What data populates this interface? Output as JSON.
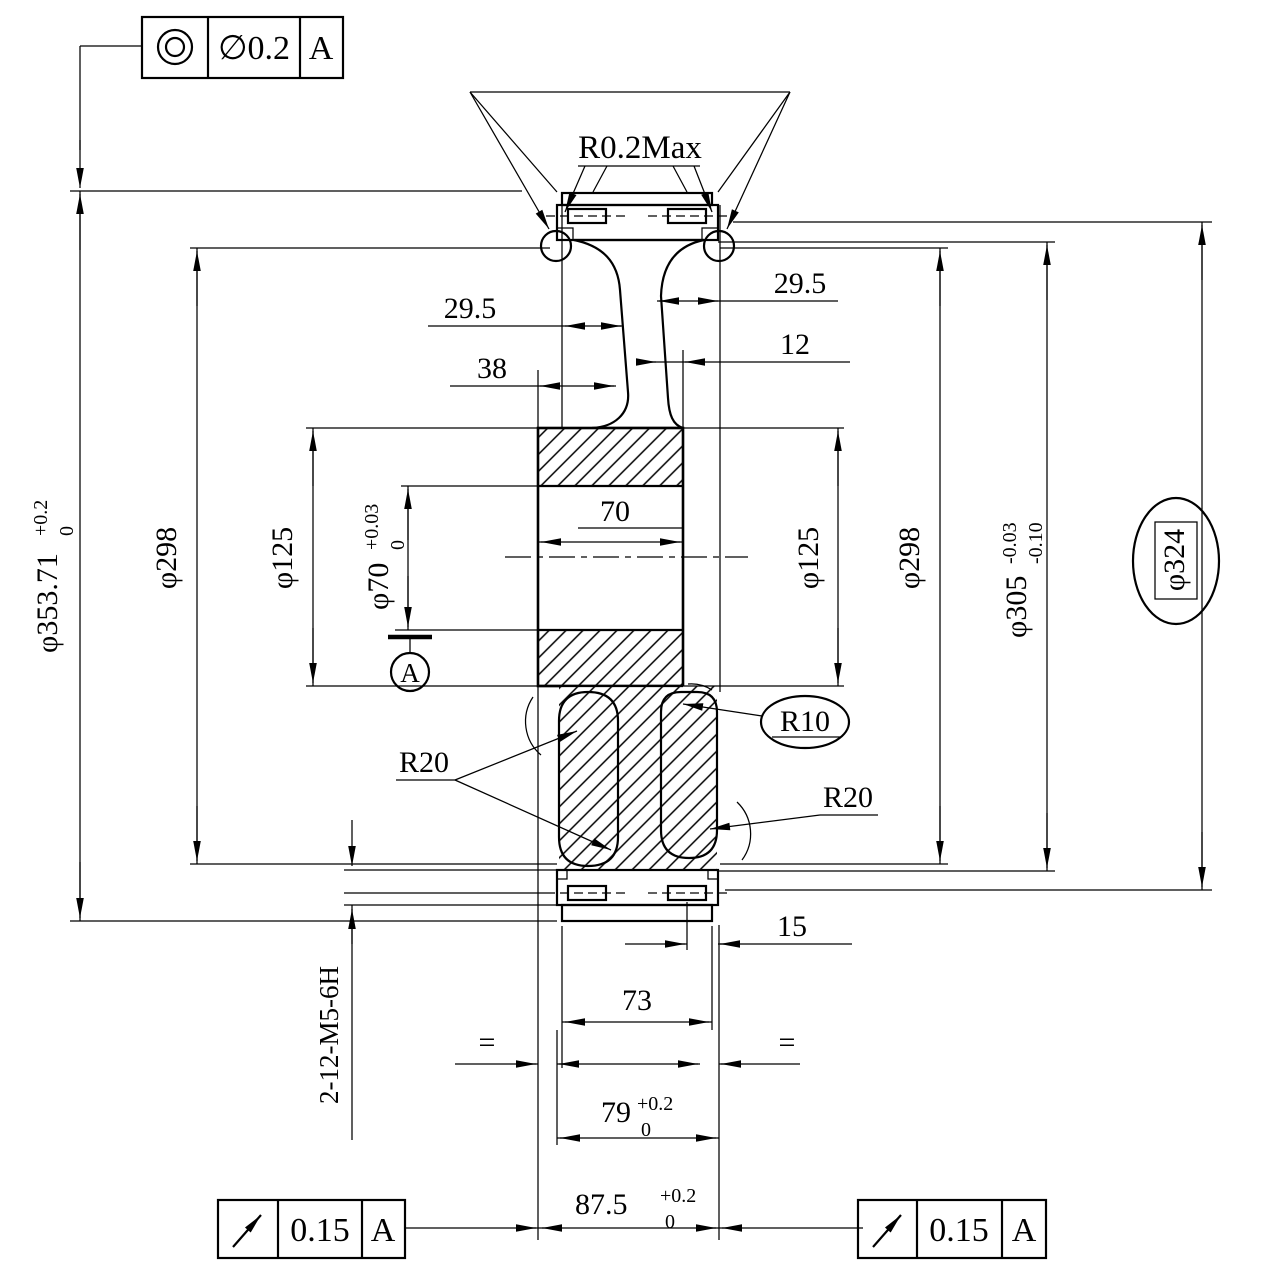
{
  "colors": {
    "ink": "#000000",
    "paper": "#ffffff"
  },
  "icons": {
    "top_frame_symbol": "concentricity-icon",
    "bottom_frames_symbol": "circular-runout-icon"
  },
  "fcf": {
    "top": {
      "symbol": "concentricity",
      "tol": "∅0.2",
      "datum": "A"
    },
    "bl": {
      "symbol": "circular-runout",
      "tol": "0.15",
      "datum": "A"
    },
    "br": {
      "symbol": "circular-runout",
      "tol": "0.15",
      "datum": "A"
    }
  },
  "datum": {
    "label": "A"
  },
  "dia": {
    "d353": {
      "main": "φ353.71",
      "sup": "+0.2",
      "sub": "0"
    },
    "d298l": "φ298",
    "d125l": "φ125",
    "d70": {
      "main": "φ70",
      "sup": "+0.03",
      "sub": "0"
    },
    "d125r": "φ125",
    "d298r": "φ298",
    "d305": {
      "main": "φ305",
      "sup": "-0.03",
      "sub": "-0.10"
    },
    "d324": "φ324"
  },
  "w": {
    "w295l": "29.5",
    "w295r": "29.5",
    "w12": "12",
    "w38": "38",
    "w70": "70",
    "w15": "15",
    "w73": "73",
    "w79": {
      "main": "79",
      "sup": "+0.2",
      "sub": "0"
    },
    "w875": {
      "main": "87.5",
      "sup": "+0.2",
      "sub": "0"
    },
    "eq": "="
  },
  "r": {
    "r02": "R0.2Max",
    "r20l": "R20",
    "r10": "R10",
    "r20r": "R20"
  },
  "note": {
    "thread": "2-12-M5-6H"
  }
}
